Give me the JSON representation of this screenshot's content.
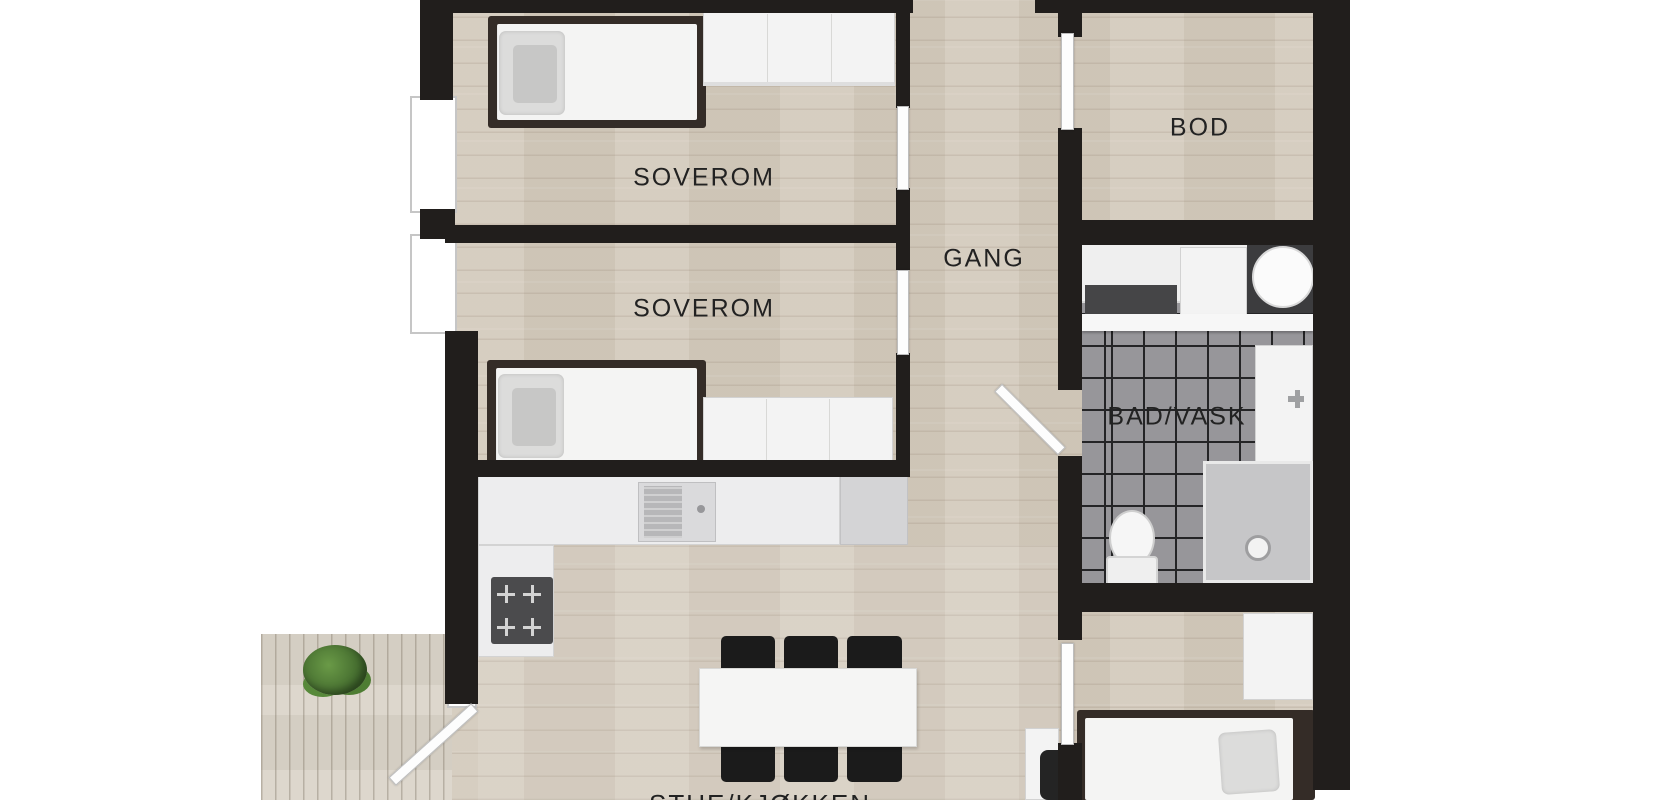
{
  "plan": {
    "type": "apartment floor plan (top-down 3D render)",
    "rooms": [
      {
        "id": "soverom-1",
        "label": "SOVEROM"
      },
      {
        "id": "soverom-2",
        "label": "SOVEROM"
      },
      {
        "id": "gang",
        "label": "GANG"
      },
      {
        "id": "bod",
        "label": "BOD"
      },
      {
        "id": "bad-vask",
        "label": "BAD/VASK"
      },
      {
        "id": "stue-kjokken",
        "label": "STUE/KJØKKEN"
      }
    ],
    "colors": {
      "background": "#ffffff",
      "wall": "#211e1c",
      "wood_floor": "#d4cbbd",
      "deck": "#dbd5ca",
      "bath_tile": "#97969a",
      "tile_grid": "#242426",
      "label_text": "#222222",
      "furniture_dark": "#1b1b1b"
    }
  }
}
